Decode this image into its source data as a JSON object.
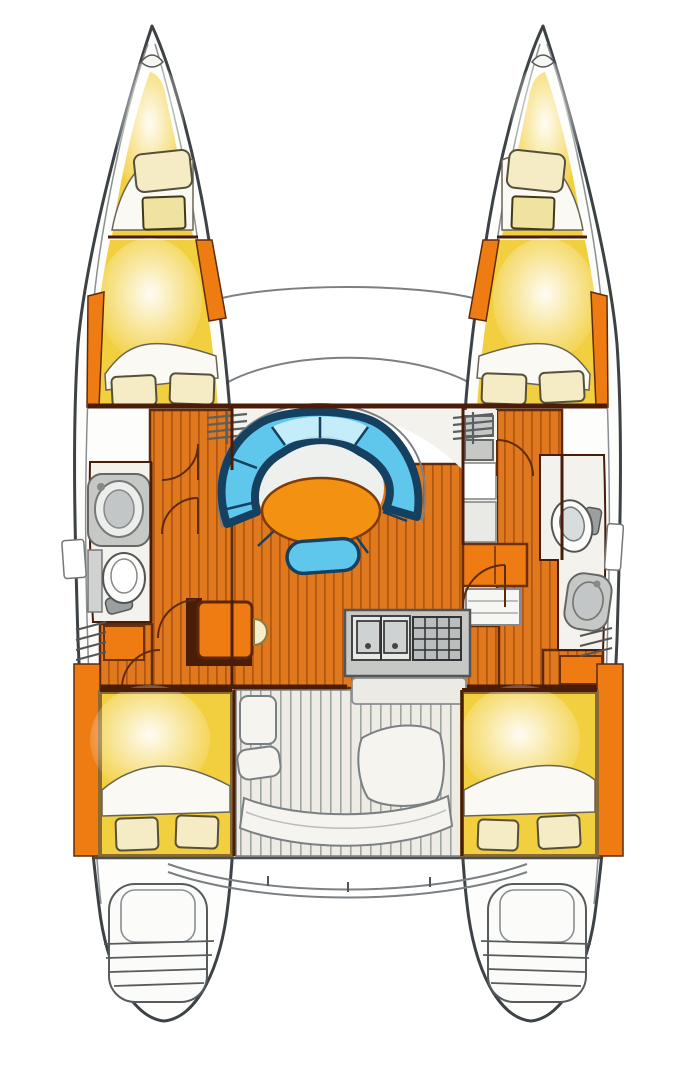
{
  "figure": {
    "kind": "catamaran interior layout plan, top-down",
    "background": "#ffffff",
    "rooms_depicted": [
      "port bow locker",
      "starboard bow locker",
      "port forward cabin",
      "starboard forward cabin",
      "port head",
      "starboard head",
      "salon with curved settee and oval table",
      "galley",
      "nav seat",
      "port aft cabin",
      "starboard aft cabin",
      "cockpit",
      "transom steps port",
      "transom steps starboard"
    ]
  },
  "palette": {
    "hull_outline": "#3c4246",
    "rubrail": "#8a8f92",
    "stroke_soft": "#7b8084",
    "cabin_yellow": "#f2cf3e",
    "wood": "#e0791e",
    "wood_line": "#b05410",
    "wood_trim": "#5e2a0a",
    "wall": "#4a1d08",
    "accent_orange": "#ee7c12",
    "table_orange": "#f29112",
    "sofa_navy": "#16405f",
    "sofa_blue": "#5fc6ec",
    "sofa_blue_light": "#cfeffb",
    "floor_white": "#f3f2ed",
    "fixture_grey": "#c6c8c6",
    "fixture_grey_dark": "#9aa0a0",
    "pillow_cream": "#f5ecc6",
    "pillow_line": "#55503a",
    "slat_bg": "#edebe3",
    "slat_line": "#9aa09b"
  }
}
